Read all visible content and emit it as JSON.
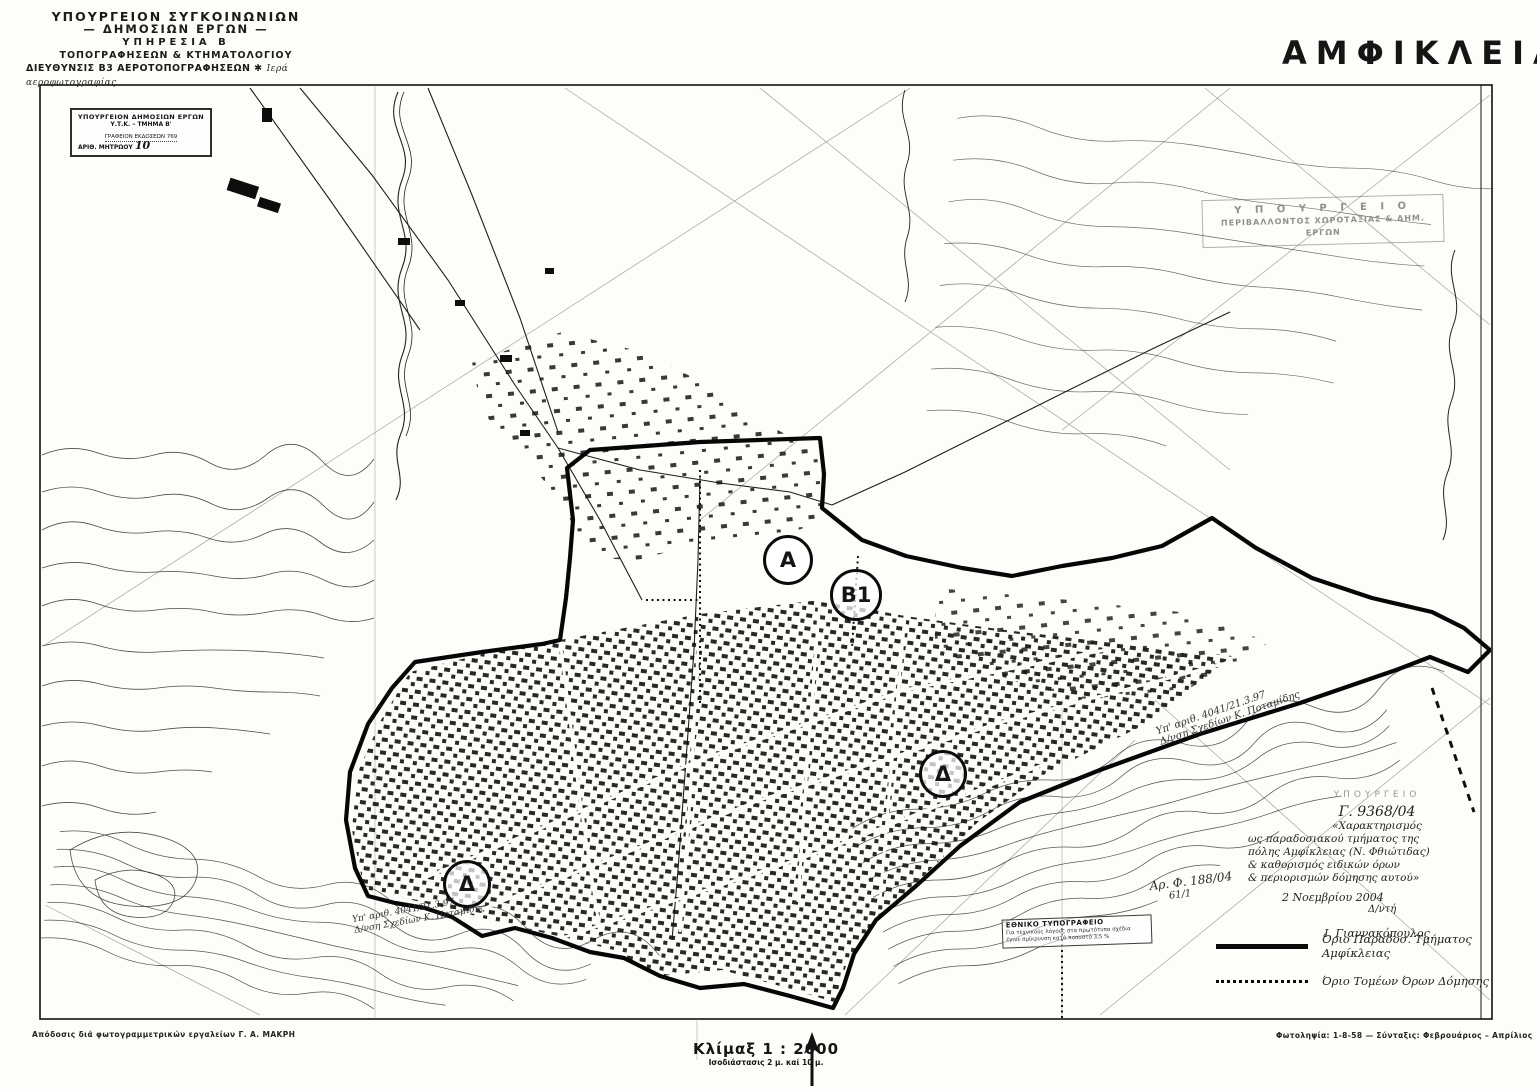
{
  "document": {
    "title": "ΑΜΦΙΚΛΕΙΑ",
    "kind": "scanned town-plan map sheet"
  },
  "header": {
    "lines": [
      "ΥΠΟΥΡΓΕΙΟΝ ΣΥΓΚΟΙΝΩΝΙΩΝ",
      "— ΔΗΜΟΣΙΩΝ ΕΡΓΩΝ —",
      "ΥΠΗΡΕΣΙΑ Β",
      "ΤΟΠΟΓΡΑΦΗΣΕΩΝ & ΚΤΗΜΑΤΟΛΟΓΙΟΥ",
      "ΔΙΕΥΘΥΝΣΙΣ Β3  ΑΕΡΟΤΟΠΟΓΡΑΦΗΣΕΩΝ ✱"
    ],
    "handwritten_note": "Ιερά αεροφωτογραφίας"
  },
  "registry_stamp": {
    "lines": [
      "ΥΠΟΥΡΓΕΙΟΝ ΔΗΜΟΣΙΩΝ ΕΡΓΩΝ",
      "Υ.Τ.Κ. – ΤΜΗΜΑ Β'",
      "ΓΡΑΦΕΙΟΝ ΕΚΔΟΣΕΩΝ 769",
      "ΑΡΙΘ. ΜΗΤΡΩΟΥ"
    ],
    "registry_number": "10"
  },
  "faded_stamp": {
    "lines": [
      "Υ Π Ο Υ Ρ Γ Ε Ι Ο",
      "ΠΕΡΙΒΑΛΛΟΝΤΟΣ ΧΩΡΟΤΑΞΙΑΣ & ΔΗΜ. ΕΡΓΩΝ"
    ]
  },
  "zone_markers": [
    {
      "label": "Α"
    },
    {
      "label": "Β1"
    },
    {
      "label": "Δ"
    },
    {
      "label": "Δ"
    }
  ],
  "boundary_notes": {
    "right": {
      "line1": "Υπ' αριθ. 4041/21.3.97",
      "line2": "Δ/νση Σχεδίων Κ. Ποταμίδης"
    },
    "left": {
      "line1": "Υπ' αριθ. 4041/21.3.97",
      "line2": "Δ/νση Σχεδίων Κ. Ποταμίδης"
    }
  },
  "approval_note": {
    "faint_header": "ΥΠΟΥΡΓΕΙΟ",
    "protocol": "Γ. 9368/04",
    "lines": [
      "«Χαρακτηρισμός",
      "ως παραδοσιακού τμήματος της",
      "πόλης Αμφίκλειας (Ν. Φθιώτιδας)",
      "& καθορισμός ειδικών όρων",
      "& περιορισμών δόμησης αυτού»"
    ],
    "date": "2 Νοεμβρίου 2004",
    "role": "Δ/ντή",
    "signature": "Ι. Γιαννακόπουλος",
    "file_ref_line1": "Αρ. Φ. 188/04",
    "file_ref_line2": "61/1"
  },
  "legend": {
    "items": [
      {
        "symbol": "solid-line",
        "label": "Όριο Παραδοσ. Τμήματος Αμφίκλειας"
      },
      {
        "symbol": "dotted-line",
        "label": "Όριο Τομέων Όρων Δόμησης"
      }
    ]
  },
  "printing_stamp": {
    "lines": [
      "ΕΘΝΙΚΟ ΤΥΠΟΓΡΑΦΕΙΟ",
      "Για τεχνικούς λόγους στα πρωτότυπα σχέδια",
      "έγινε σμίκρυνση κατά ποσοστό 3,5 %"
    ]
  },
  "scale": {
    "label": "Κλίμαξ 1 : 2000",
    "interval": "Ισοδιάστασις 2 μ. καί 10 μ."
  },
  "credits": {
    "left": "Απόδοσις διά φωτογραμμετρικών εργαλείων Γ. Α. ΜΑΚΡΗ",
    "right": "Φωτοληψία: 1-8-58 — Σύνταξις: Φεβρουάριος – Απρίλιος"
  },
  "colors": {
    "ink": "#151515",
    "paper": "#fdfdfa",
    "faded_stamp": "#8f8f8f"
  }
}
